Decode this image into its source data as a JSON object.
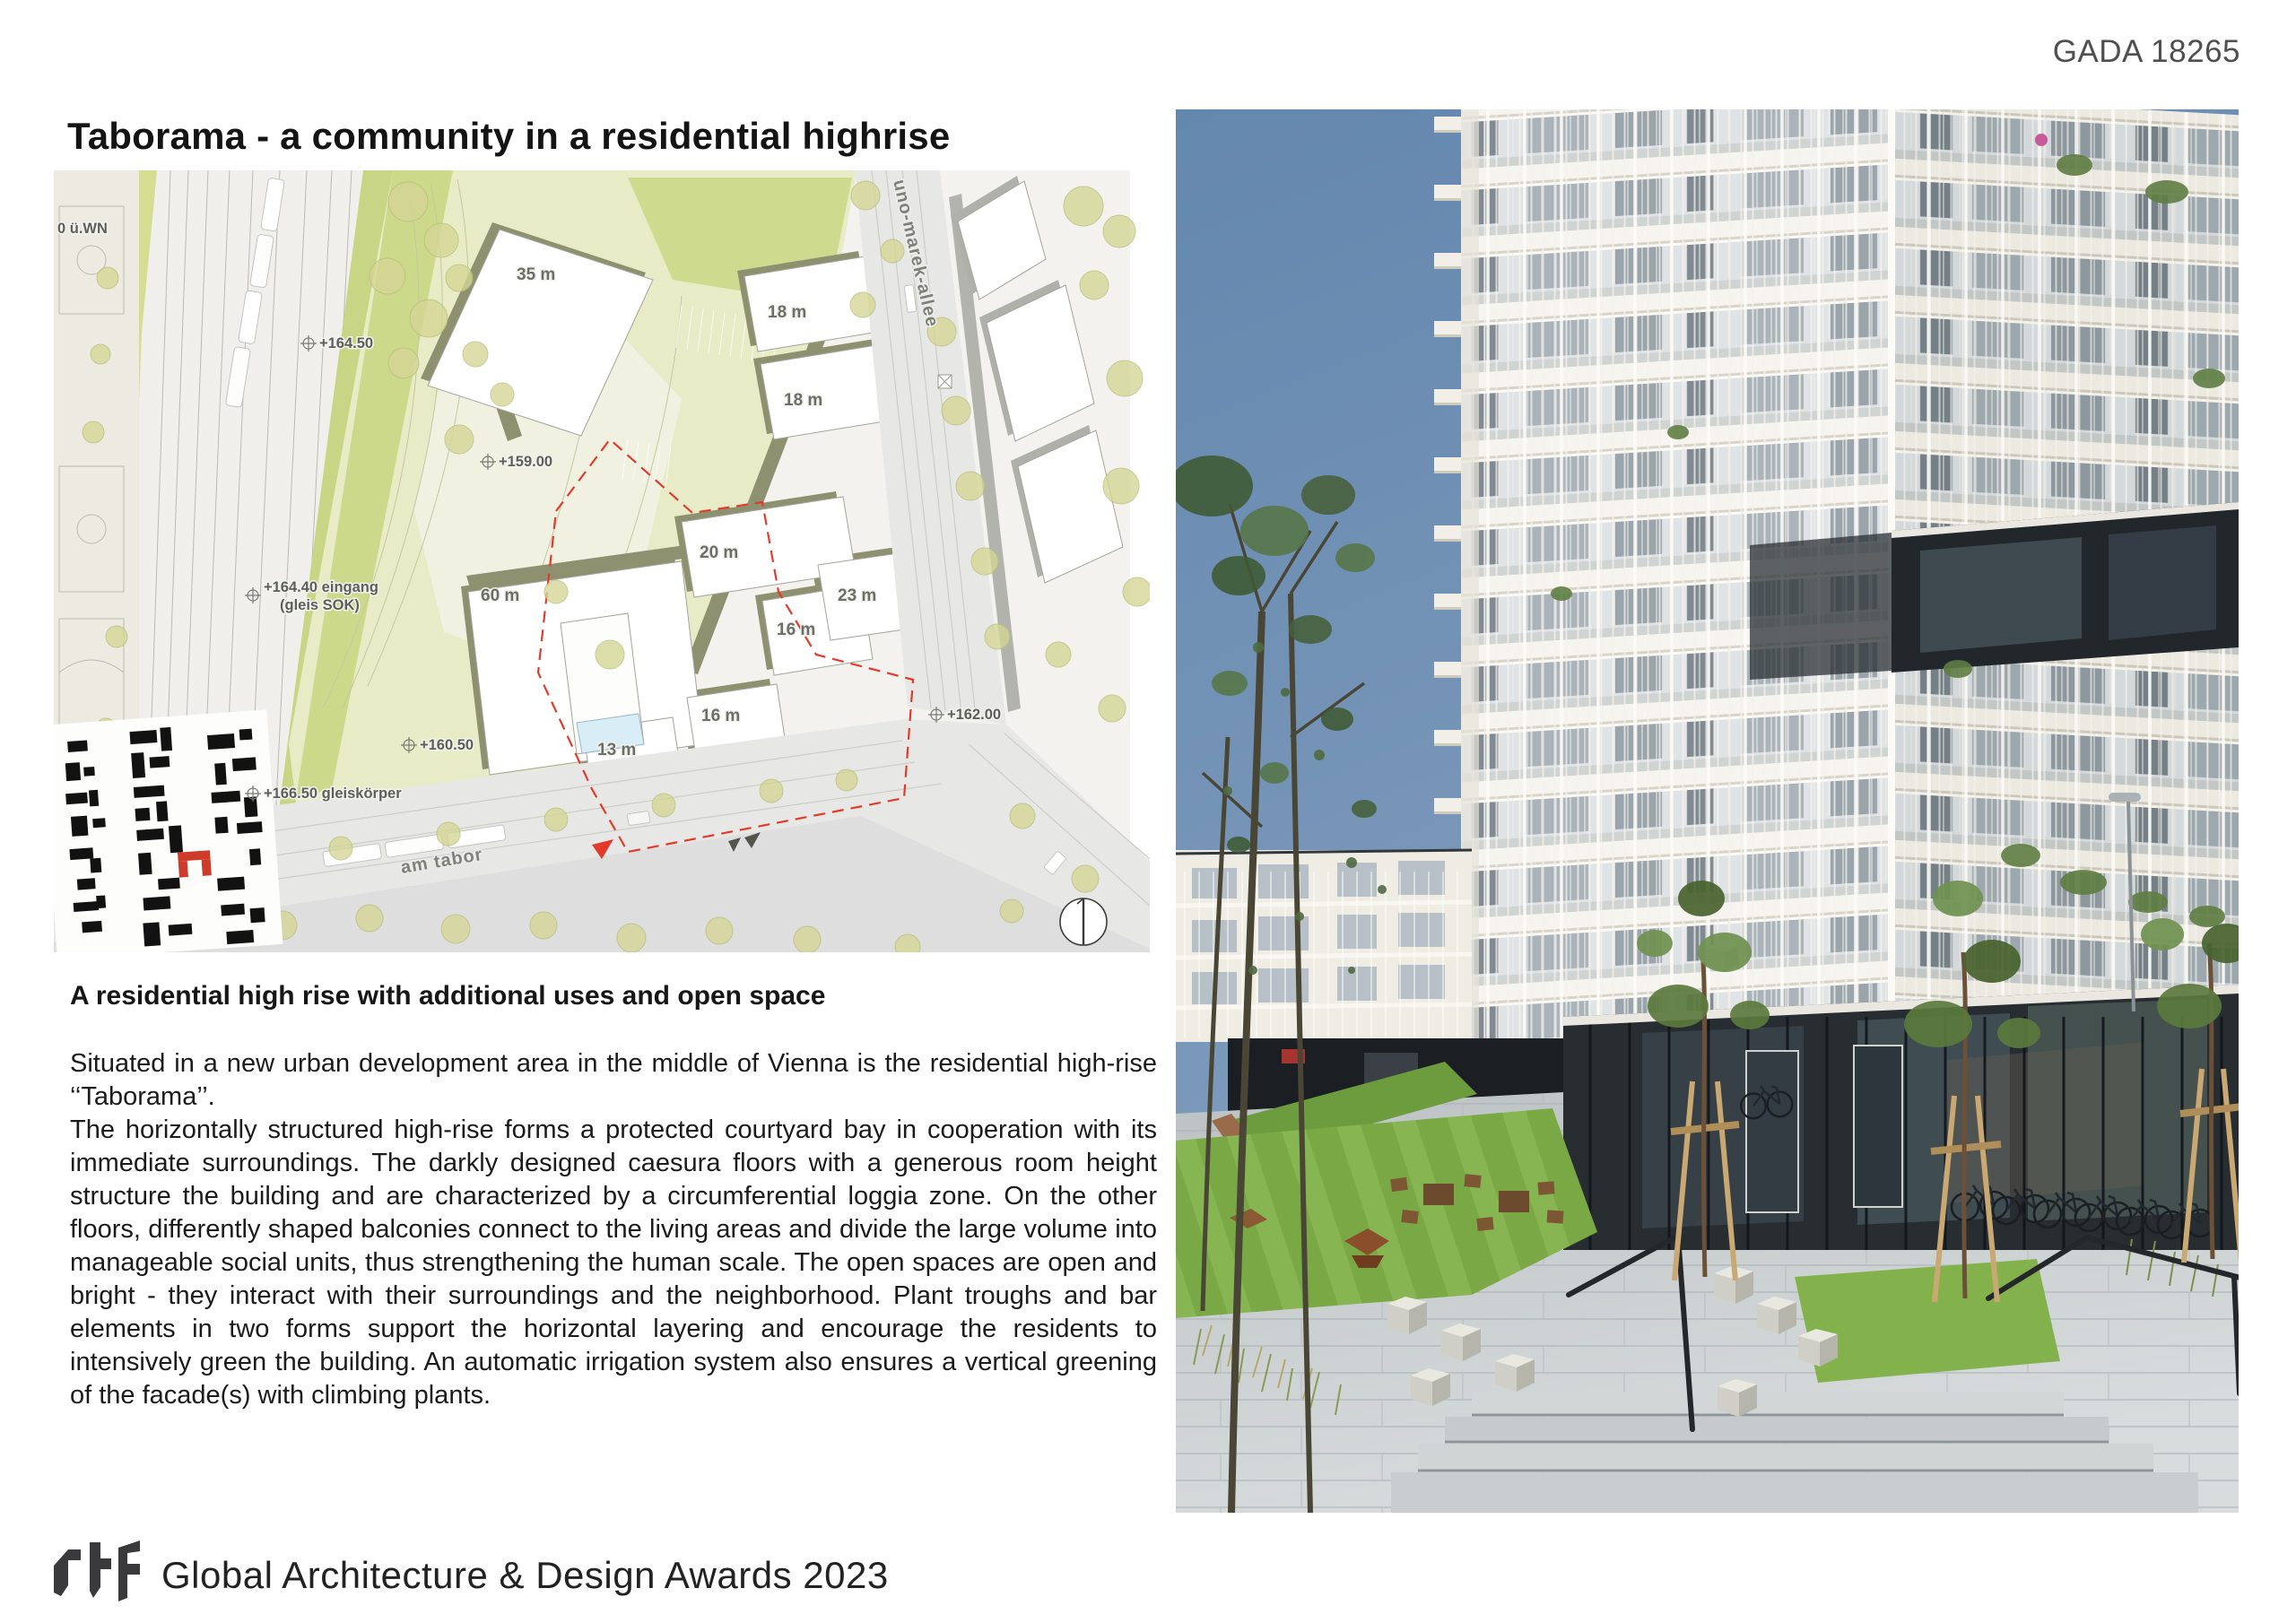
{
  "header": {
    "ref": "GADA 18265"
  },
  "title": "Taborama - a community in a residential highrise",
  "caption": "A residential high rise with additional uses and open space",
  "body": [
    "Situated in a new urban development area in the middle of Vienna is the residential high-rise ‘‘Taborama’’.",
    "The horizontally structured high-rise forms a protected courtyard bay in cooperation with its immediate surroundings. The darkly designed caesura floors with a generous room height structure the building and are characterized by a circumferential loggia zone. On the other floors, differently shaped balconies connect to the living areas and divide the large volume into manageable social units, thus strengthening the human scale. The open spaces are open and bright - they interact with their surroundings and the neighborhood. Plant troughs and bar elements in two forms support the horizontal layering and encourage the residents to intensively green the building. An automatic irrigation system also ensures a vertical greening of the facade(s) with climbing plants."
  ],
  "plan": {
    "labels": {
      "uwn": "0 ü.WN",
      "e1": "+164.50",
      "e2": "+159.00",
      "e3": "+160.50",
      "e4": "+162.00",
      "e5a": "+164.40 eingang",
      "e5b": "(gleis SOK)",
      "e6": "+166.50 gleiskörper",
      "d35": "35 m",
      "d18a": "18 m",
      "d18b": "18 m",
      "d20": "20 m",
      "d16a": "16 m",
      "d23": "23 m",
      "d60": "60 m",
      "d13": "13 m",
      "d16b": "16 m",
      "street_allee": "uno-marek-allee",
      "street_tabor": "am tabor"
    }
  },
  "footer": {
    "logo": "rtf",
    "text": "Global Architecture & Design Awards 2023"
  },
  "colors": {
    "accent_red": "#e23b2c",
    "plan_green": "#cfdc8e",
    "sky_blue": "#6a8ab0",
    "text": "#1c1c1c"
  }
}
